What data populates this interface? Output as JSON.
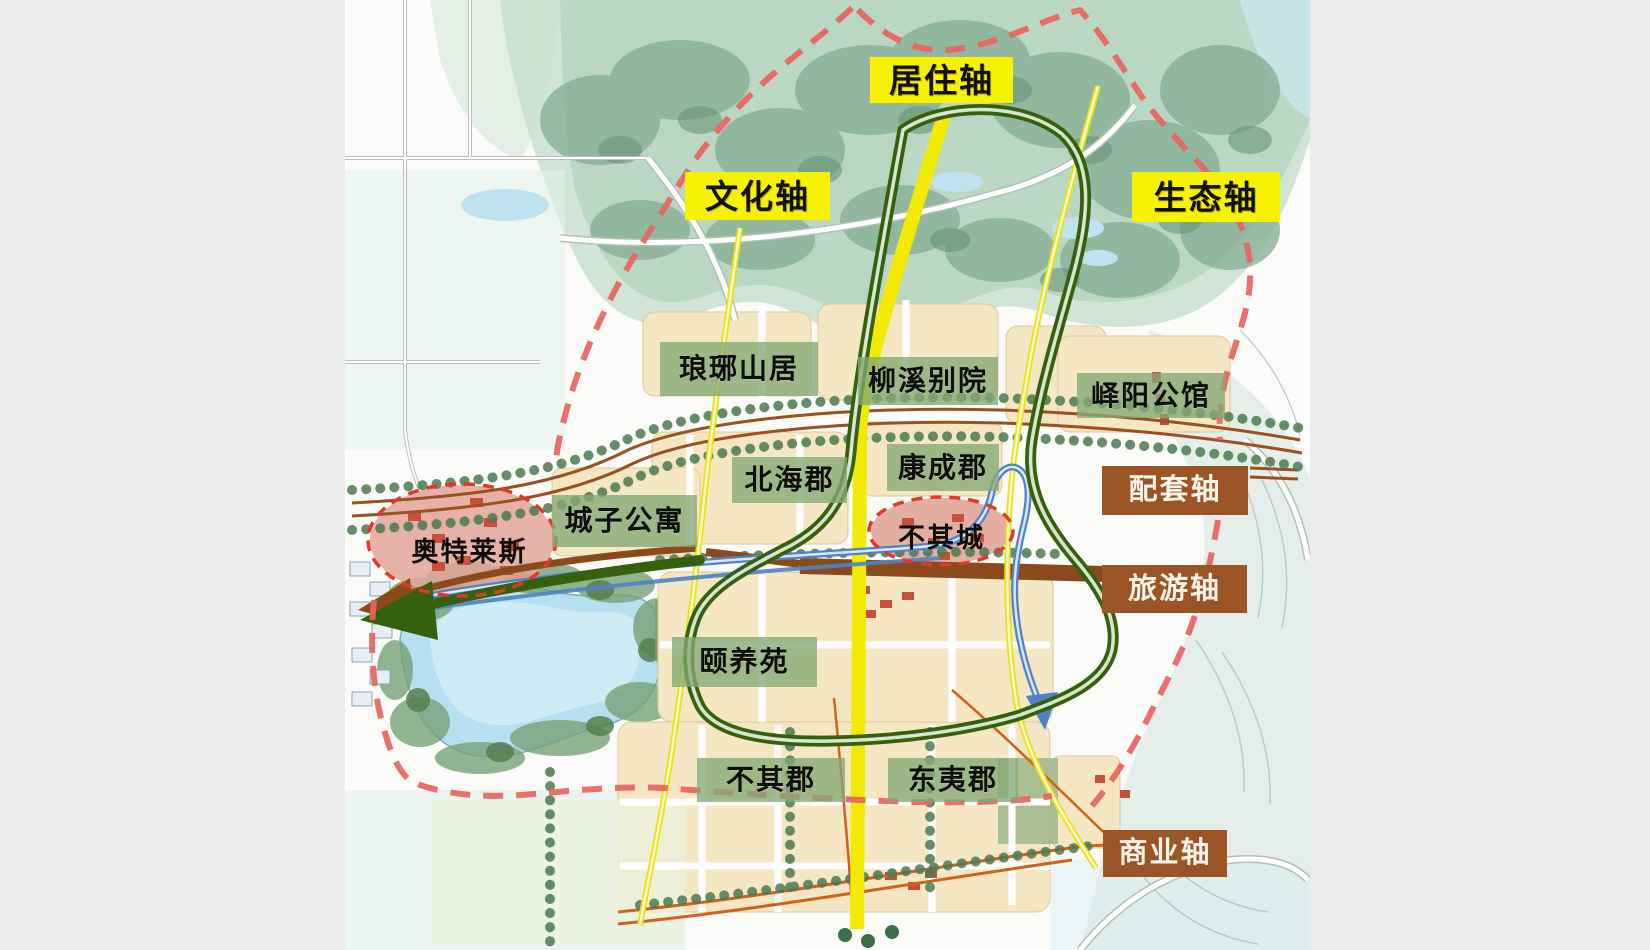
{
  "colors": {
    "page_bg": "#ececec",
    "paper_bg": "#fbfbf9",
    "axis_label_yellow_bg": "#f7f200",
    "axis_label_yellow_text": "#101010",
    "axis_label_brown_bg": "#9b5426",
    "axis_label_brown_text": "#f7f2ea",
    "district_label_bg": "rgba(132,168,116,0.78)",
    "district_label_text": "#0d0d0d",
    "axis_line_yellow": "#f2ea00",
    "axis_line_green": "#35610e",
    "axis_line_blue": "#4f82c6",
    "axis_line_brown": "#8a4a1c",
    "boundary_red": "#e8645c",
    "landmark_ellipse_red": "#e03a28"
  },
  "axis_labels": [
    {
      "id": "residential-axis",
      "text": "居住轴",
      "style": "yellow",
      "x": 870,
      "y": 57,
      "w": 143,
      "h": 46
    },
    {
      "id": "culture-axis",
      "text": "文化轴",
      "style": "yellow",
      "x": 685,
      "y": 172,
      "w": 145,
      "h": 48
    },
    {
      "id": "ecology-axis",
      "text": "生态轴",
      "style": "yellow",
      "x": 1132,
      "y": 172,
      "w": 148,
      "h": 50
    },
    {
      "id": "supporting-axis",
      "text": "配套轴",
      "style": "brown",
      "x": 1102,
      "y": 466,
      "w": 146,
      "h": 49
    },
    {
      "id": "tourism-axis",
      "text": "旅游轴",
      "style": "brown",
      "x": 1102,
      "y": 565,
      "w": 145,
      "h": 48
    },
    {
      "id": "commercial-axis",
      "text": "商业轴",
      "style": "brown",
      "x": 1103,
      "y": 830,
      "w": 124,
      "h": 47
    }
  ],
  "district_labels": [
    {
      "id": "langya-shanju",
      "text": "琅琊山居",
      "x": 660,
      "y": 342,
      "w": 158,
      "h": 54
    },
    {
      "id": "liuxi-bieyuan",
      "text": "柳溪别院",
      "x": 858,
      "y": 357,
      "w": 140,
      "h": 48
    },
    {
      "id": "yiyang-gongguan",
      "text": "峄阳公馆",
      "x": 1077,
      "y": 373,
      "w": 148,
      "h": 45
    },
    {
      "id": "beihai-jun",
      "text": "北海郡",
      "x": 732,
      "y": 457,
      "w": 115,
      "h": 46
    },
    {
      "id": "kangcheng-jun",
      "text": "康成郡",
      "x": 887,
      "y": 444,
      "w": 112,
      "h": 47
    },
    {
      "id": "chengzi-gongyu",
      "text": "城子公寓",
      "x": 552,
      "y": 495,
      "w": 145,
      "h": 52
    },
    {
      "id": "yiyang-yuan",
      "text": "颐养苑",
      "x": 672,
      "y": 637,
      "w": 145,
      "h": 50
    },
    {
      "id": "buqi-jun",
      "text": "不其郡",
      "x": 697,
      "y": 758,
      "w": 148,
      "h": 44
    },
    {
      "id": "dongyi-jun",
      "text": "东夷郡",
      "x": 888,
      "y": 758,
      "w": 130,
      "h": 44
    }
  ],
  "landmark_labels": [
    {
      "id": "aotelaisi",
      "text": "奥特莱斯",
      "x": 412,
      "y": 536,
      "w": 115,
      "h": 32
    },
    {
      "id": "buqi-cheng",
      "text": "不其城",
      "x": 894,
      "y": 522,
      "w": 95,
      "h": 32
    }
  ]
}
